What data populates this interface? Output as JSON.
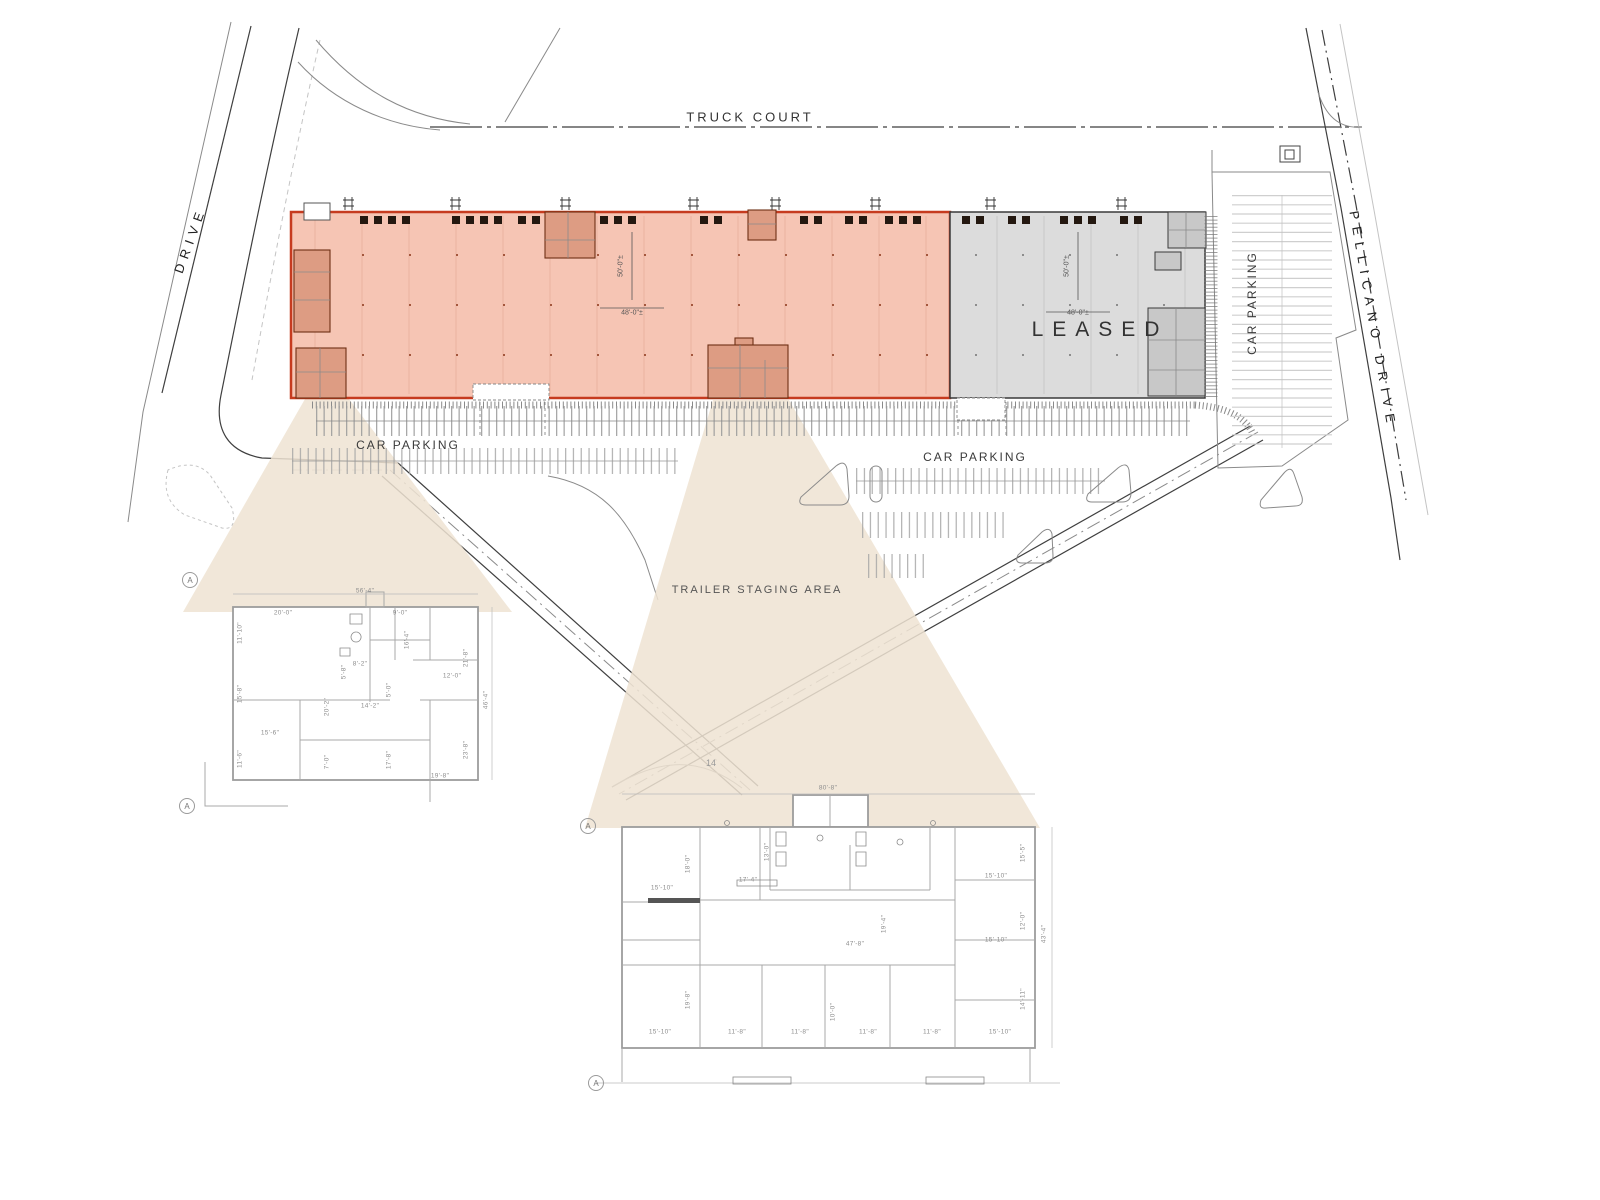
{
  "labels": {
    "truck_court": "TRUCK COURT",
    "left_street": "DRIVE",
    "right_street": "PELLICANO DRIVE",
    "car_parking_1": "CAR PARKING",
    "car_parking_2": "CAR PARKING",
    "car_parking_3": "CAR PARKING",
    "trailer_staging": "TRAILER STAGING AREA",
    "leased": "LEASED",
    "road_number": "14",
    "section_marker": "A"
  },
  "building": {
    "available": {
      "dim_v": "50'-0\"±",
      "dim_h": "48'-0\"±"
    },
    "leased": {
      "dim_v": "50'-0\"±",
      "dim_h": "48'-0\"±"
    }
  },
  "left_plan": {
    "dims": [
      "56'-4\"",
      "20'-0\"",
      "9'-0\"",
      "11'-10\"",
      "16'-4\"",
      "21'-8\"",
      "12'-0\"",
      "8'-2\"",
      "5'-8\"",
      "15'-8\"",
      "20'-2\"",
      "5'-0\"",
      "14'-2\"",
      "46'-4\"",
      "15'-6\"",
      "11'-6\"",
      "7'-0\"",
      "17'-8\"",
      "23'-8\"",
      "19'-8\""
    ]
  },
  "right_plan": {
    "dims": [
      "80'-8\"",
      "15'-10\"",
      "18'-0\"",
      "17'-4\"",
      "13'-0\"",
      "15'-5\"",
      "15'-10\"",
      "12'-0\"",
      "15'-10\"",
      "43'-4\"",
      "19'-4\"",
      "47'-8\"",
      "19'-8\"",
      "14'-11\"",
      "15'-10\"",
      "11'-8\"",
      "11'-8\"",
      "10'-0\"",
      "11'-8\"",
      "11'-8\"",
      "15'-10\""
    ]
  },
  "colors": {
    "available_fill": "#f6c5b4",
    "available_stroke": "#c63b1f",
    "office_fill": "#dd9c83",
    "office_stroke": "#6e3014",
    "leased_fill": "#dcdcdc",
    "leased_office_fill": "#c8c8c8",
    "cone_fill": "#efe3d2"
  }
}
